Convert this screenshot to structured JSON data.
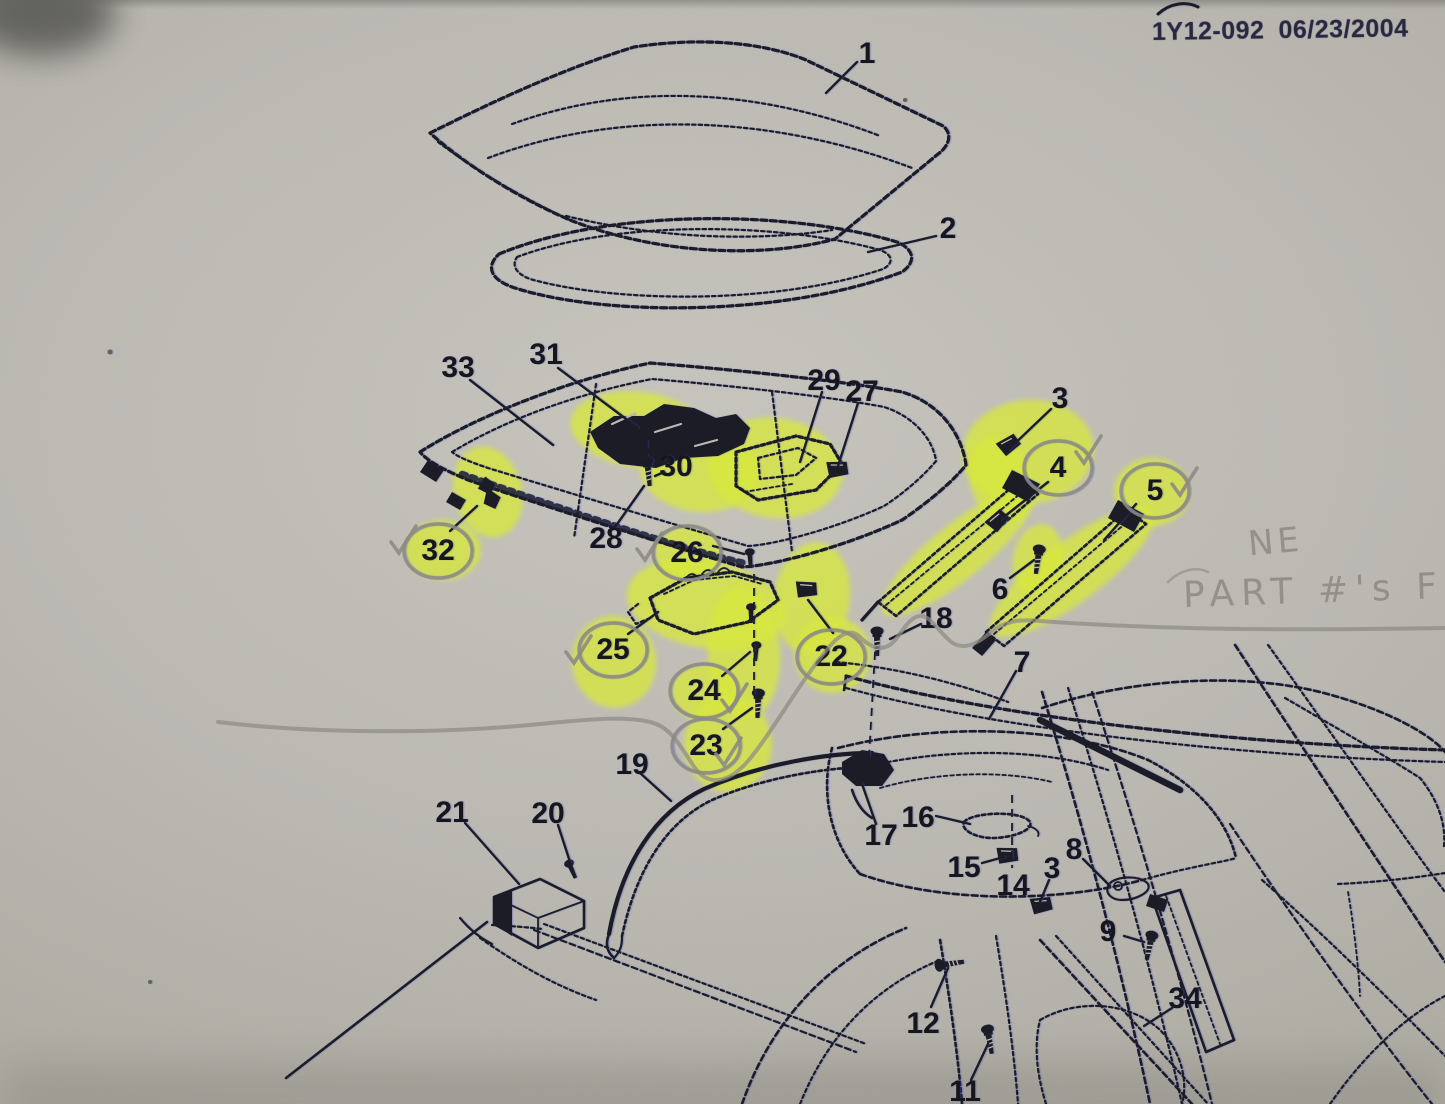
{
  "header": {
    "code": "1Y12-092",
    "date": "06/23/2004"
  },
  "handwriting": {
    "line1": "NE",
    "line2": "PART #'s FO"
  },
  "colors": {
    "paper": "#bab8b1",
    "ink": "#1c1c26",
    "highlighter": "#d8e83d",
    "pencil": "#8d8b84",
    "header_ink": "#282841"
  },
  "diagram": {
    "labels": [
      {
        "num": "1",
        "x": 867,
        "y": 52
      },
      {
        "num": "2",
        "x": 948,
        "y": 227
      },
      {
        "num": "33",
        "x": 458,
        "y": 366
      },
      {
        "num": "31",
        "x": 546,
        "y": 353
      },
      {
        "num": "29",
        "x": 824,
        "y": 379
      },
      {
        "num": "27",
        "x": 862,
        "y": 390
      },
      {
        "num": "3",
        "x": 1060,
        "y": 397
      },
      {
        "num": "4",
        "x": 1058,
        "y": 466,
        "circled": true
      },
      {
        "num": "5",
        "x": 1155,
        "y": 489,
        "circled": true
      },
      {
        "num": "6",
        "x": 1000,
        "y": 588
      },
      {
        "num": "18",
        "x": 936,
        "y": 617
      },
      {
        "num": "7",
        "x": 1022,
        "y": 661
      },
      {
        "num": "32",
        "x": 438,
        "y": 549,
        "circled": true
      },
      {
        "num": "28",
        "x": 606,
        "y": 537
      },
      {
        "num": "30",
        "x": 676,
        "y": 465
      },
      {
        "num": "26",
        "x": 687,
        "y": 551,
        "circled": true
      },
      {
        "num": "25",
        "x": 613,
        "y": 648,
        "circled": true
      },
      {
        "num": "24",
        "x": 704,
        "y": 689,
        "circled": true
      },
      {
        "num": "22",
        "x": 831,
        "y": 655,
        "circled": true
      },
      {
        "num": "23",
        "x": 706,
        "y": 744,
        "circled": true
      },
      {
        "num": "19",
        "x": 632,
        "y": 763
      },
      {
        "num": "21",
        "x": 452,
        "y": 811
      },
      {
        "num": "20",
        "x": 548,
        "y": 812
      },
      {
        "num": "17",
        "x": 881,
        "y": 834
      },
      {
        "num": "16",
        "x": 918,
        "y": 816
      },
      {
        "num": "15",
        "x": 964,
        "y": 866
      },
      {
        "num": "14",
        "x": 1013,
        "y": 884
      },
      {
        "num": "3",
        "x": 1052,
        "y": 867
      },
      {
        "num": "8",
        "x": 1074,
        "y": 848
      },
      {
        "num": "9",
        "x": 1108,
        "y": 930
      },
      {
        "num": "12",
        "x": 923,
        "y": 1022
      },
      {
        "num": "11",
        "x": 965,
        "y": 1090
      },
      {
        "num": "34",
        "x": 1185,
        "y": 997
      }
    ],
    "leaders": [
      [
        857,
        62,
        826,
        93
      ],
      [
        936,
        236,
        868,
        252
      ],
      [
        470,
        380,
        553,
        445
      ],
      [
        558,
        368,
        638,
        428
      ],
      [
        822,
        392,
        800,
        462
      ],
      [
        858,
        403,
        838,
        466
      ],
      [
        1051,
        409,
        1008,
        450
      ],
      [
        1048,
        482,
        1000,
        520
      ],
      [
        1136,
        504,
        1104,
        540
      ],
      [
        1010,
        578,
        1034,
        560
      ],
      [
        1016,
        671,
        989,
        719
      ],
      [
        921,
        624,
        890,
        639
      ],
      [
        450,
        531,
        477,
        506
      ],
      [
        615,
        527,
        644,
        486
      ],
      [
        664,
        472,
        655,
        476
      ],
      [
        713,
        546,
        744,
        554
      ],
      [
        628,
        634,
        658,
        612
      ],
      [
        722,
        676,
        750,
        652
      ],
      [
        833,
        633,
        808,
        600
      ],
      [
        723,
        729,
        752,
        708
      ],
      [
        640,
        773,
        671,
        801
      ],
      [
        465,
        823,
        519,
        884
      ],
      [
        558,
        825,
        570,
        862
      ],
      [
        876,
        824,
        862,
        784
      ],
      [
        936,
        816,
        970,
        824
      ],
      [
        982,
        863,
        1004,
        857
      ],
      [
        1049,
        880,
        1040,
        902
      ],
      [
        1083,
        859,
        1110,
        886
      ],
      [
        1124,
        936,
        1144,
        942
      ],
      [
        931,
        1007,
        948,
        968
      ],
      [
        971,
        1080,
        988,
        1044
      ],
      [
        1172,
        1008,
        1144,
        1026
      ]
    ],
    "alignment_lines": [
      [
        754,
        574,
        754,
        696
      ],
      [
        875,
        652,
        869,
        757
      ],
      [
        1012,
        795,
        1012,
        868
      ],
      [
        647,
        440,
        647,
        456
      ]
    ],
    "highlights": [
      {
        "cx": 640,
        "cy": 430,
        "rx": 70,
        "ry": 38,
        "rot": 8
      },
      {
        "cx": 700,
        "cy": 470,
        "rx": 60,
        "ry": 42,
        "rot": 5
      },
      {
        "cx": 775,
        "cy": 468,
        "rx": 68,
        "ry": 50,
        "rot": 8
      },
      {
        "cx": 488,
        "cy": 492,
        "rx": 34,
        "ry": 46,
        "rot": -14
      },
      {
        "cx": 443,
        "cy": 550,
        "rx": 38,
        "ry": 30,
        "rot": 0
      },
      {
        "cx": 688,
        "cy": 552,
        "rx": 34,
        "ry": 26,
        "rot": 0
      },
      {
        "cx": 706,
        "cy": 604,
        "rx": 80,
        "ry": 44,
        "rot": 10
      },
      {
        "cx": 614,
        "cy": 662,
        "rx": 42,
        "ry": 46,
        "rot": -8
      },
      {
        "cx": 744,
        "cy": 652,
        "rx": 36,
        "ry": 66,
        "rot": -4
      },
      {
        "cx": 705,
        "cy": 692,
        "rx": 34,
        "ry": 28,
        "rot": 0
      },
      {
        "cx": 728,
        "cy": 744,
        "rx": 44,
        "ry": 48,
        "rot": 0
      },
      {
        "cx": 812,
        "cy": 598,
        "rx": 38,
        "ry": 56,
        "rot": 8
      },
      {
        "cx": 833,
        "cy": 655,
        "rx": 38,
        "ry": 38,
        "rot": 0
      },
      {
        "cx": 1028,
        "cy": 452,
        "rx": 66,
        "ry": 52,
        "rot": -6
      },
      {
        "cx": 1000,
        "cy": 480,
        "rx": 30,
        "ry": 44,
        "rot": -18
      },
      {
        "cx": 958,
        "cy": 552,
        "rx": 96,
        "ry": 27,
        "rot": -39
      },
      {
        "cx": 1072,
        "cy": 572,
        "rx": 100,
        "ry": 30,
        "rot": -37
      },
      {
        "cx": 1152,
        "cy": 492,
        "rx": 38,
        "ry": 34,
        "rot": 0
      },
      {
        "cx": 1038,
        "cy": 560,
        "rx": 25,
        "ry": 36,
        "rot": 10
      }
    ],
    "checkmarks": [
      {
        "x": 403,
        "y": 542
      },
      {
        "x": 649,
        "y": 549
      },
      {
        "x": 578,
        "y": 652
      },
      {
        "x": 734,
        "y": 700
      },
      {
        "x": 728,
        "y": 754
      },
      {
        "x": 1088,
        "y": 452
      },
      {
        "x": 1184,
        "y": 484
      }
    ],
    "fasteners": [
      {
        "x": 648,
        "y": 470,
        "rot": -6,
        "type": "screw"
      },
      {
        "x": 489,
        "y": 492,
        "rot": -14,
        "type": "grommet"
      },
      {
        "x": 750,
        "y": 557,
        "rot": -4,
        "type": "bolt"
      },
      {
        "x": 751,
        "y": 612,
        "rot": 0,
        "type": "bolt"
      },
      {
        "x": 756,
        "y": 650,
        "rot": 4,
        "type": "bolt"
      },
      {
        "x": 758,
        "y": 702,
        "rot": 2,
        "type": "screw"
      },
      {
        "x": 805,
        "y": 590,
        "rot": 14,
        "type": "clip"
      },
      {
        "x": 836,
        "y": 470,
        "rot": 10,
        "type": "clip"
      },
      {
        "x": 877,
        "y": 640,
        "rot": 0,
        "type": "screw"
      },
      {
        "x": 1008,
        "y": 446,
        "rot": -18,
        "type": "clip"
      },
      {
        "x": 997,
        "y": 522,
        "rot": -30,
        "type": "clip"
      },
      {
        "x": 1038,
        "y": 558,
        "rot": 8,
        "type": "screw"
      },
      {
        "x": 571,
        "y": 868,
        "rot": -24,
        "type": "bolt"
      },
      {
        "x": 1006,
        "y": 856,
        "rot": 12,
        "type": "clip"
      },
      {
        "x": 1040,
        "y": 906,
        "rot": 6,
        "type": "clip"
      },
      {
        "x": 948,
        "y": 964,
        "rot": -98,
        "type": "screw"
      },
      {
        "x": 989,
        "y": 1038,
        "rot": -10,
        "type": "screw"
      },
      {
        "x": 1150,
        "y": 944,
        "rot": 12,
        "type": "screw"
      }
    ]
  }
}
